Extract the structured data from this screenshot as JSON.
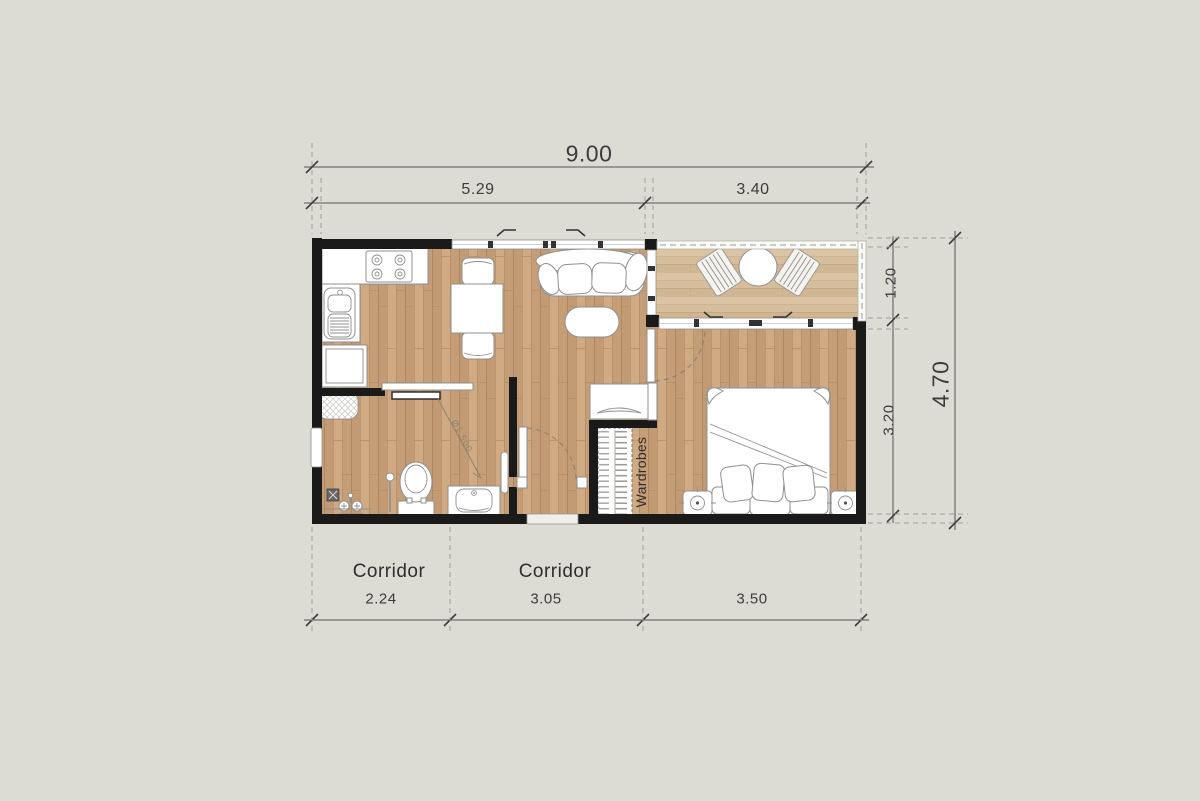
{
  "plan": {
    "dimensions": {
      "total_width": "9.00",
      "width_left": "5.29",
      "width_right": "3.40",
      "right_top": "1.20",
      "right_bottom": "3.20",
      "total_height": "4.70",
      "bottom_left": "2.24",
      "bottom_mid": "3.05",
      "bottom_right": "3.50"
    },
    "labels": {
      "corridor_left": "Corridor",
      "corridor_mid": "Corridor",
      "wardrobes": "Wardrobes",
      "turning_note": "Ø1.500"
    },
    "colors": {
      "background": "#dcdcd4",
      "wall": "#1a1a1a",
      "floor_wood": "#c9a37c",
      "balcony_wood": "#d6bd9c",
      "furniture_fill": "#ffffff",
      "furniture_stroke": "#8f8f8f",
      "dim_text": "#3c3c3c"
    }
  }
}
